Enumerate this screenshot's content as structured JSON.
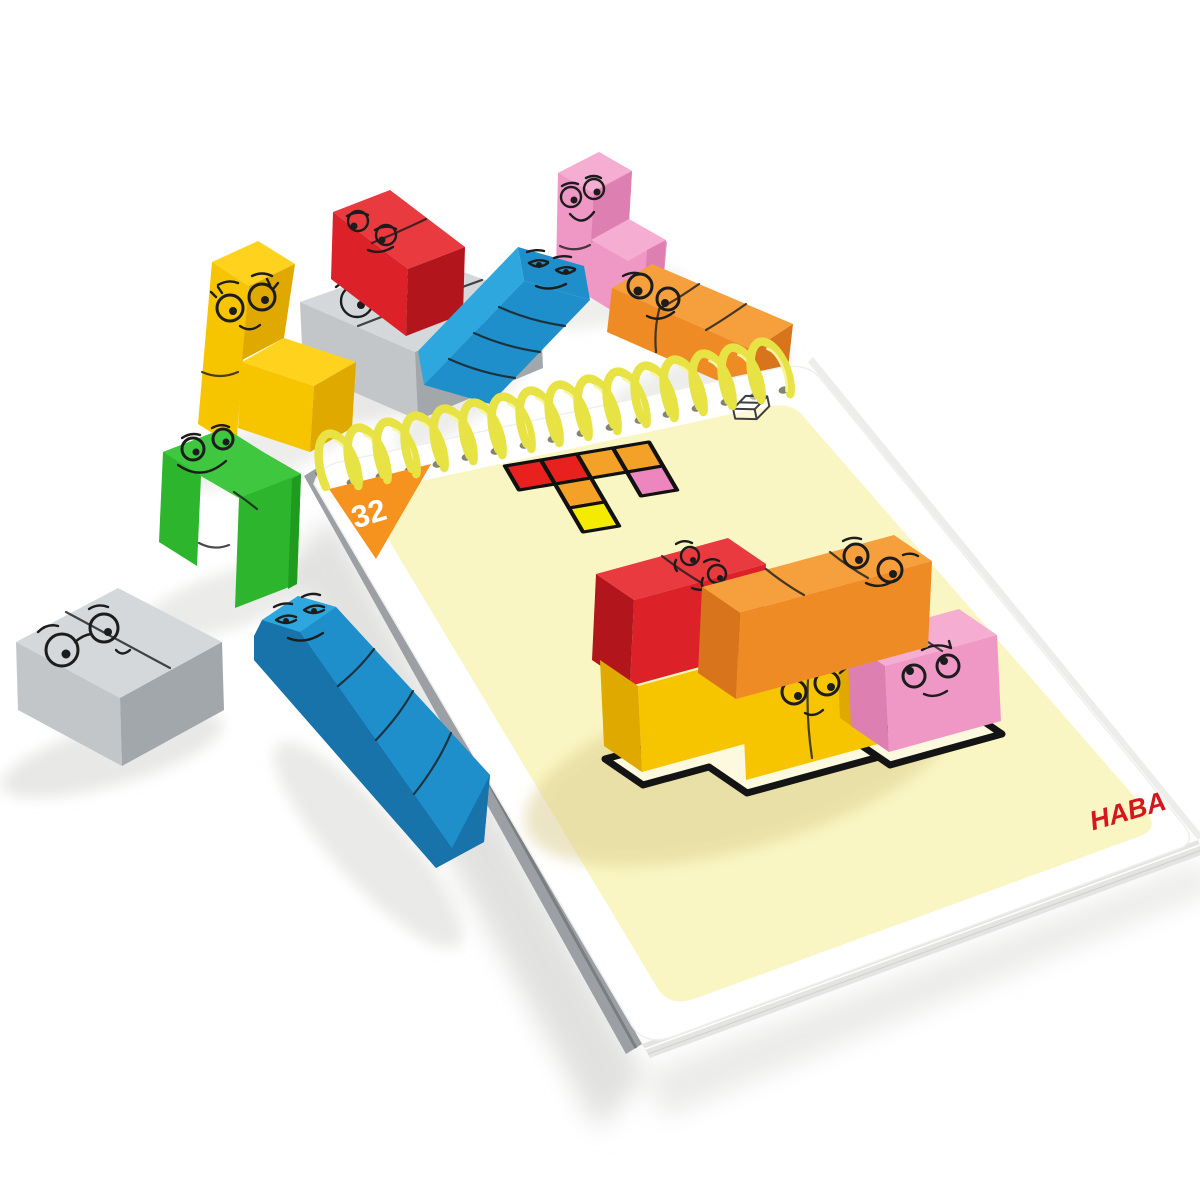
{
  "scene": {
    "description": "Product photo: HABA wooden logic-block puzzle pieces with cartoon faces around a yellow spiral-bound puzzle card pad; puzzle card 32 shows a colored block diagram and a solved block arrangement on a black outline."
  },
  "pad": {
    "page_number": "32",
    "brand": "HABA",
    "icon": "cube-outline-icon",
    "binding": "yellow-spiral"
  },
  "puzzle_diagram": {
    "rows": 3,
    "cols": 4,
    "cells": [
      {
        "color": "red",
        "col": 0,
        "row": 0
      },
      {
        "color": "red",
        "col": 1,
        "row": 0
      },
      {
        "color": "orange",
        "col": 2,
        "row": 0
      },
      {
        "color": "orange",
        "col": 3,
        "row": 0
      },
      {
        "color": "orange",
        "col": 1,
        "row": 1
      },
      {
        "color": "pink",
        "col": 3,
        "row": 1
      },
      {
        "color": "yellow",
        "col": 1,
        "row": 2
      }
    ]
  },
  "solved_blocks": [
    {
      "color": "red",
      "shape": "domino-bar",
      "expression": "dizzy-swirl-eyes"
    },
    {
      "color": "orange",
      "shape": "long-bar",
      "expression": "googly-eyes"
    },
    {
      "color": "yellow",
      "shape": "L-piece",
      "expression": "happy-lashes"
    },
    {
      "color": "pink",
      "shape": "domino-bar",
      "expression": "upward-glance"
    }
  ],
  "loose_blocks": [
    {
      "color": "yellow",
      "shape": "L-piece",
      "expression": "happy-lashes"
    },
    {
      "color": "gray",
      "shape": "square-slab",
      "expression": "glasses-smile"
    },
    {
      "color": "red",
      "shape": "domino-bar",
      "expression": "amused-glance"
    },
    {
      "color": "pink",
      "shape": "corner-step",
      "expression": "big-grin"
    },
    {
      "color": "blue",
      "shape": "long-bar",
      "expression": "sleepy-smirk"
    },
    {
      "color": "orange",
      "shape": "long-bar",
      "expression": "googly-eyes"
    },
    {
      "color": "green",
      "shape": "zigzag",
      "expression": "cheerful-grin"
    },
    {
      "color": "gray",
      "shape": "flat-square",
      "expression": "glasses-smile"
    },
    {
      "color": "blue",
      "shape": "long-bar",
      "expression": "sleepy-smirk"
    }
  ],
  "colors": {
    "background": "#ffffff",
    "card_face": "#FAF6C3",
    "card_margin": "#FFFFFF",
    "triangle": "#F6921E",
    "number": "#FFFFFF",
    "logo": "#D6161D",
    "spiral": "#E7E345",
    "spiral_light": "#F7F4A0",
    "hole": "#6E6E5A",
    "outline": "#141414",
    "face_ink": "#1C1C1C",
    "footprint_fill": "#FCF9DF",
    "card_shadow": "#D9CC8C",
    "table_shadow": "#DEDEDB",
    "diagram": {
      "red": "#E8201E",
      "orange": "#F4A227",
      "yellow": "#F4EB00",
      "pink": "#EE86BE",
      "outline": "#111111"
    },
    "blocks": {
      "red": {
        "top": "#E93A40",
        "front": "#DC2128",
        "side": "#B2151B"
      },
      "orange": {
        "top": "#F59F3D",
        "front": "#EF8B25",
        "side": "#D8741B"
      },
      "yellow": {
        "top": "#FFD21E",
        "front": "#F7C400",
        "side": "#DFA900"
      },
      "pink": {
        "top": "#F5ADD2",
        "front": "#EF97C5",
        "side": "#DE7FB2"
      },
      "blue": {
        "top": "#2EA7DF",
        "front": "#1F8FCB",
        "side": "#1773A9"
      },
      "green": {
        "top": "#3FC73F",
        "front": "#2EB52E",
        "side": "#1F9C1F"
      },
      "gray": {
        "top": "#D5D8DA",
        "front": "#C2C6C9",
        "side": "#A2A7AB"
      }
    }
  }
}
